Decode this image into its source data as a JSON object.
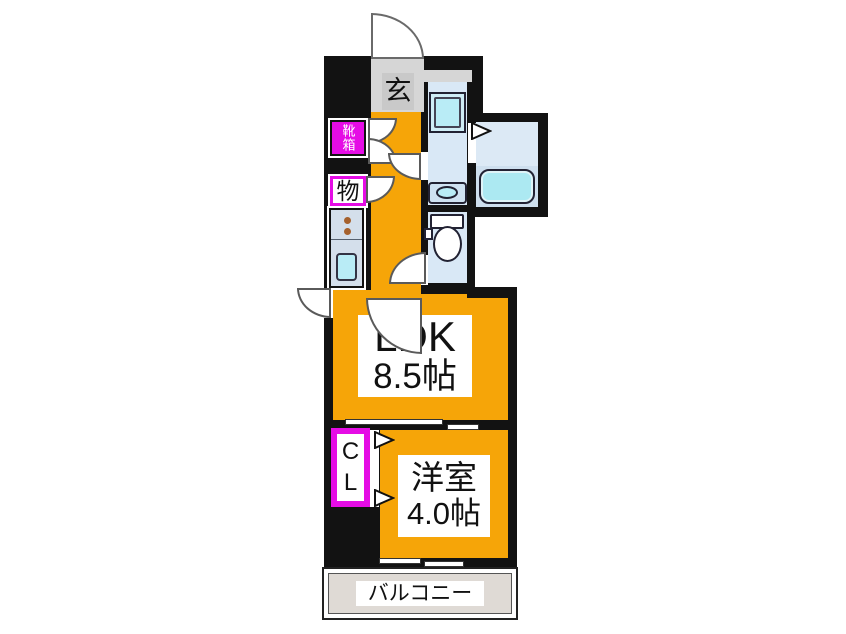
{
  "floorplan": {
    "entrance": {
      "label": "玄"
    },
    "shoebox": {
      "label": "靴箱"
    },
    "storage": {
      "label": "物"
    },
    "ldk": {
      "name": "LDK",
      "size": "8.5帖"
    },
    "closet": {
      "line1": "C",
      "line2": "L"
    },
    "western_room": {
      "name": "洋室",
      "size": "4.0帖"
    },
    "balcony": {
      "label": "バルコニー"
    },
    "colors": {
      "wall": "#121212",
      "room_orange": "#F6A508",
      "accent_magenta": "#E50CE5",
      "floor_blue": "#D9E8F6",
      "fixture_cyan": "#B9ECF6",
      "balcony_floor": "#DFDAD5",
      "entrance_gray": "#D6D6D6"
    }
  }
}
